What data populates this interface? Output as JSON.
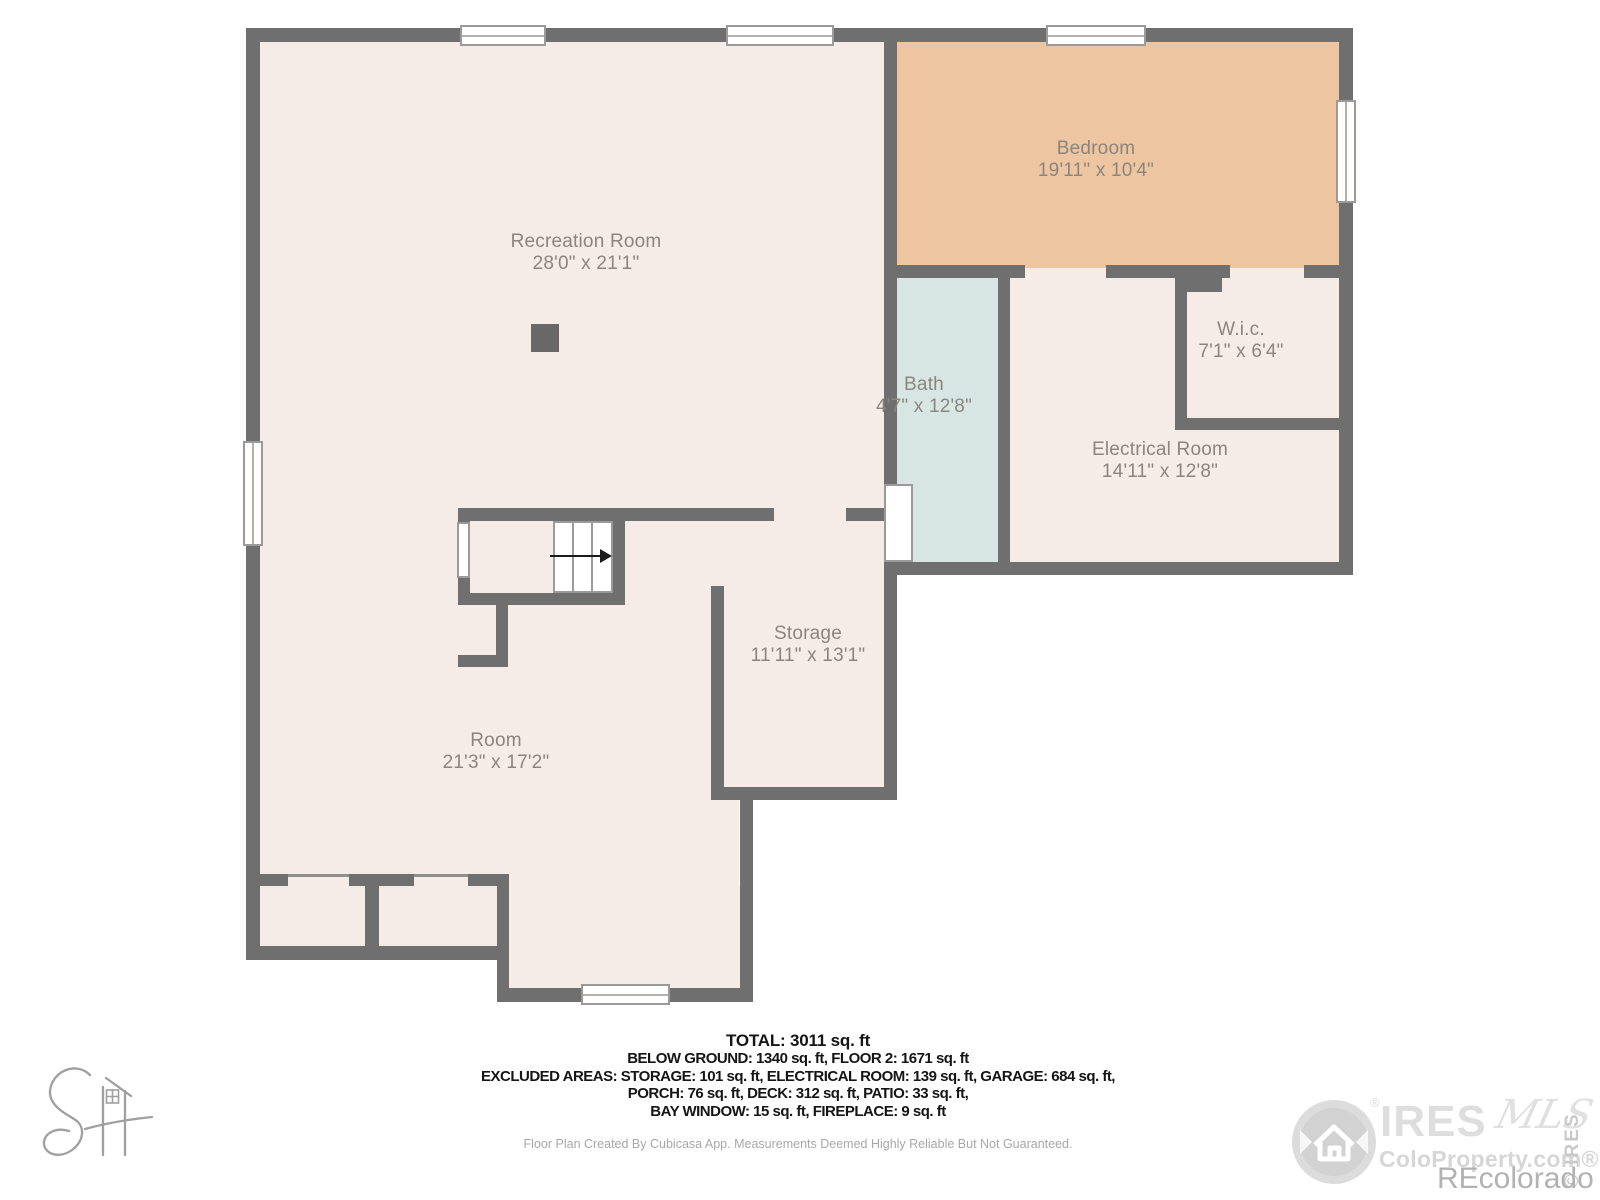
{
  "floor_plan": {
    "rooms": [
      {
        "name": "Recreation Room",
        "dimensions": "28'0\" x 21'1\""
      },
      {
        "name": "Bedroom",
        "dimensions": "19'11\" x 10'4\""
      },
      {
        "name": "Bath",
        "dimensions": "4'7\" x 12'8\""
      },
      {
        "name": "W.i.c.",
        "dimensions": "7'1\" x 6'4\""
      },
      {
        "name": "Electrical Room",
        "dimensions": "14'11\" x 12'8\""
      },
      {
        "name": "Storage",
        "dimensions": "11'11\" x 13'1\""
      },
      {
        "name": "Room",
        "dimensions": "21'3\" x 17'2\""
      }
    ],
    "colors": {
      "wall": "#6f6f6f",
      "floor": "#f6ece7",
      "bedroom_floor": "#edc5a0",
      "bath_floor": "#d8e6e3",
      "label_text": "#8a857f"
    }
  },
  "summary": {
    "total": "TOTAL: 3011 sq. ft",
    "line2": "BELOW GROUND: 1340 sq. ft, FLOOR 2: 1671 sq. ft",
    "line3": "EXCLUDED AREAS: STORAGE: 101 sq. ft, ELECTRICAL ROOM: 139 sq. ft, GARAGE: 684 sq. ft,",
    "line4": "PORCH: 76 sq. ft, DECK: 312 sq. ft, PATIO: 33 sq. ft,",
    "line5": "BAY WINDOW: 15 sq. ft, FIREPLACE: 9 sq. ft"
  },
  "disclaimer": "Floor Plan Created By Cubicasa App. Measurements Deemed Highly Reliable But Not Guaranteed.",
  "watermark": {
    "brand": "IRES",
    "script": "MLS",
    "reg": "®",
    "site": "ColoProperty.com®",
    "vertical": "© IRES",
    "recolorado": "REcolorado"
  }
}
